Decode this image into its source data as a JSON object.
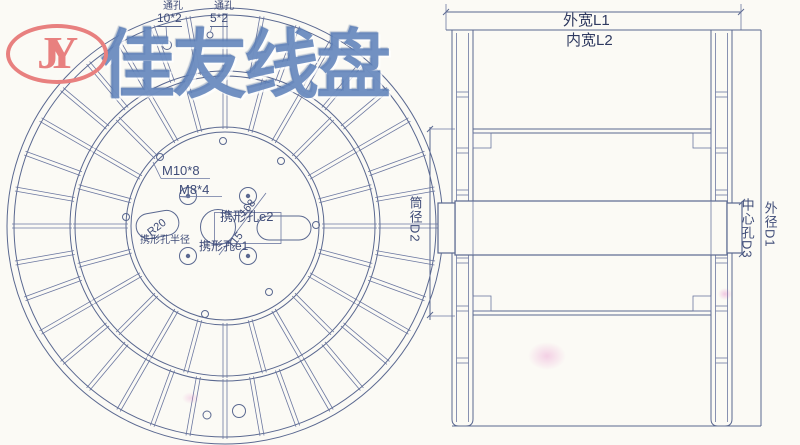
{
  "logo": {
    "text": "JY"
  },
  "watermark": {
    "text": "佳友线盘"
  },
  "front_view": {
    "callouts": [
      {
        "label": "通孔",
        "value": "10*2"
      },
      {
        "label": "通孔",
        "value": "5*2"
      }
    ],
    "labels": {
      "bolt_spec_m10": "M10*8",
      "bolt_spec_m8": "M8*4",
      "slot_e2": "携形孔e2",
      "slot_e1": "携形孔e1",
      "slot_radius_caption": "携形孔半径",
      "slot_radius_value": "R20",
      "diag_dim_outer": "168",
      "diag_dim_inner": "115"
    }
  },
  "side_view": {
    "dimensions": {
      "outer_width": "外宽L1",
      "inner_width": "内宽L2",
      "barrel_diameter": "筒径D2",
      "center_hole": "中心孔D3",
      "outer_diameter": "外径D1"
    }
  },
  "colors": {
    "line": "#5a6890",
    "label_text": "#3f4c78",
    "logo_red": "#e8807f",
    "watermark_blue": "#5d80b8"
  }
}
